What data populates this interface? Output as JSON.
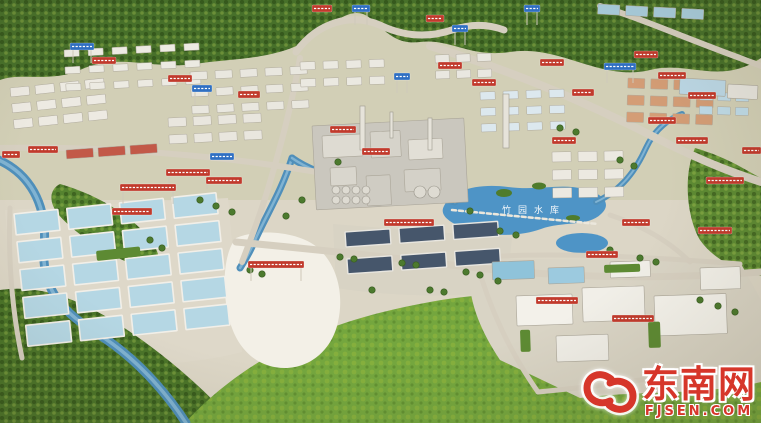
{
  "image_alt": "Aerial photograph of a physical scale model (sand table) of an industrial park: forested hills on top, chemical plant with chimneys in the center, blue reservoir, grids of blue ponds on the left, dark-roofed warehouses, a white undeveloped plot, a factory campus at bottom right, many small red banner labels and blue road signs, green fields in the foreground",
  "watermark": {
    "site_name": "东南网",
    "site_url": "FJSEN.COM",
    "color": "#d6362a"
  },
  "pond_label": {
    "text": "竹园水库",
    "x": 502,
    "y": 213
  },
  "colors": {
    "sign_red": "#c13a2c",
    "sign_blue": "#2f6fc2",
    "forest_dark": "#47702a",
    "grass_bright": "#74a63e",
    "water": "#4f8fba",
    "pond": "#4e94c6",
    "ground": "#d9d3c3"
  },
  "scene": {
    "terrain": [
      {
        "n": "base-upper",
        "d": "M0,0 H761 V210 H0 Z",
        "fill": "#d2cfb6"
      },
      {
        "n": "base-lower",
        "d": "M0,200 H761 V423 H0 Z",
        "fill": "#dcd6c6"
      },
      {
        "n": "pond-grid-platform",
        "d": "M5,210 L228,198 L242,352 C180,368 88,370 18,358 Z",
        "fill": "#ded8c9"
      },
      {
        "n": "warehouse-platform",
        "d": "M333,224 L512,238 L506,292 C450,298 388,296 336,288 Z",
        "fill": "#d8d3c4"
      },
      {
        "n": "top-forest",
        "d": "M0,0 H761 V58 C720,86 688,60 650,70 C600,82 560,44 510,52 C470,58 450,38 420,42 C395,45 385,30 370,18 C350,2 330,28 305,42 C270,60 235,58 195,64 C150,70 120,52 80,70 C50,83 20,72 0,80 Z",
        "fill": "#47702a",
        "tex": 1
      },
      {
        "n": "right-hillside",
        "d": "M695,148 C730,158 750,173 761,178 L761,276 C740,272 714,260 700,240 C688,220 682,178 695,148 Z",
        "fill": "#5d8a33",
        "tex": 1
      },
      {
        "n": "riverside-trees",
        "d": "M60,184 C95,194 130,214 150,239 C165,259 160,274 140,267 C110,257 75,234 58,214 C48,201 50,189 60,184 Z",
        "fill": "#55832f",
        "tex": 1
      },
      {
        "n": "bottom-left-forest",
        "d": "M0,290 C40,284 80,300 115,322 C160,350 200,385 235,423 L0,423 Z",
        "fill": "#4a7429",
        "tex": 1
      },
      {
        "n": "bottom-grass",
        "d": "M185,423 C248,354 330,320 430,302 C540,282 650,300 761,345 L761,423 Z",
        "fill": "#74a63e",
        "tex": 2
      },
      {
        "n": "campus-platform",
        "d": "M470,258 L740,262 L761,300 L761,382 C700,396 640,390 580,398 L500,360 C480,330 465,296 470,258 Z",
        "fill": "#d9d4c5"
      },
      {
        "n": "undeveloped-white-area",
        "d": "M236,238 C260,228 300,232 318,248 C338,266 344,295 338,322 C332,350 310,368 285,368 C258,368 238,350 230,322 C222,295 222,255 236,238 Z",
        "fill": "#f3f0e7"
      },
      {
        "n": "reservoir",
        "d": "M444,206 C452,190 478,183 508,187 C538,191 560,183 584,189 C604,194 612,204 601,214 C588,227 562,221 541,229 C516,238 482,236 463,228 C449,222 439,215 444,206 Z",
        "fill": "#4e94c6"
      },
      {
        "n": "small-pond",
        "d": "M556,243 a26,10 0 1 0 52,0 a26,10 0 1 0 -52,0",
        "fill": "#4e94c6"
      },
      {
        "n": "island",
        "d": "M496,193 a8,4 0 1 0 16,0 a8,4 0 1 0 -16,0",
        "fill": "#4f7c2c"
      },
      {
        "n": "island",
        "d": "M532,186 a7,3.5 0 1 0 14,0 a7,3.5 0 1 0 -14,0",
        "fill": "#4f7c2c"
      },
      {
        "n": "island",
        "d": "M566,218 a7,3 0 1 0 14,0 a7,3 0 1 0 -14,0",
        "fill": "#4f7c2c"
      }
    ],
    "rivers": [
      {
        "d": "M-6,158 C30,172 48,205 44,248 C41,292 66,314 98,334 C135,357 166,392 186,423",
        "w": 9,
        "c": "#4f8fba",
        "hw": 3.5,
        "hc": "#8cbcd8"
      },
      {
        "d": "M292,158 C282,190 268,212 256,238 C250,252 244,262 240,268",
        "w": 7,
        "c": "#4f8fba",
        "hw": 2.5,
        "hc": "#8cbcd8"
      },
      {
        "d": "M455,202 C420,192 382,186 348,180 C326,176 306,168 292,158",
        "w": 7,
        "c": "#4f8fba",
        "hw": 2.5,
        "hc": "#8cbcd8"
      },
      {
        "d": "M596,202 C622,190 636,170 646,148 C654,131 666,120 682,114",
        "w": 6,
        "c": "#4f8fba",
        "hw": 2,
        "hc": "#8cbcd8"
      }
    ],
    "roads": [
      {
        "d": "M296,52 C318,22 352,12 382,26 C404,36 428,38 452,30 C470,24 488,24 504,30",
        "w": 7
      },
      {
        "d": "M430,46 C510,70 590,104 660,140 C710,165 740,175 761,182",
        "w": 8
      },
      {
        "d": "M300,58 C292,104 282,142 270,182 C262,210 252,236 242,262",
        "w": 6
      },
      {
        "d": "M0,148 C80,146 170,152 250,162 C310,170 340,176 370,182",
        "w": 6
      },
      {
        "d": "M236,242 C300,248 380,256 460,266 C560,278 660,280 761,272",
        "w": 7
      },
      {
        "d": "M600,6 C640,18 690,40 740,58 C750,62 756,64 761,66",
        "w": 6
      },
      {
        "d": "M610,215 C640,225 668,240 690,262",
        "w": 5
      },
      {
        "d": "M10,208 C8,260 12,310 22,358",
        "w": 5
      },
      {
        "d": "M470,258 C540,252 640,256 740,264",
        "w": 5
      },
      {
        "d": "M476,260 C490,310 510,352 538,392",
        "w": 5
      },
      {
        "d": "M538,392 C600,386 660,378 722,368",
        "w": 5
      },
      {
        "d": "M452,210 L598,224",
        "w": 2.5,
        "c": "#ebe7dc",
        "dash": "4 3"
      }
    ],
    "clusters": [
      {
        "x": 10,
        "y": 88,
        "cols": 4,
        "rows": 3,
        "w": 19,
        "h": 9,
        "gx": 6,
        "gy": 7,
        "rot": -6,
        "roof": "#edeae2"
      },
      {
        "x": 66,
        "y": 150,
        "cols": 3,
        "rows": 1,
        "w": 27,
        "h": 9,
        "gx": 5,
        "gy": 0,
        "rot": -4,
        "roof": "#c25948"
      },
      {
        "x": 64,
        "y": 50,
        "cols": 6,
        "rows": 3,
        "w": 15,
        "h": 7,
        "gx": 9,
        "gy": 10,
        "rot": -3,
        "roof": "#eceae2"
      },
      {
        "x": 190,
        "y": 72,
        "cols": 5,
        "rows": 3,
        "w": 17,
        "h": 8,
        "gx": 8,
        "gy": 9,
        "rot": -3,
        "roof": "#e9e7df"
      },
      {
        "x": 300,
        "y": 62,
        "cols": 4,
        "rows": 2,
        "w": 15,
        "h": 8,
        "gx": 8,
        "gy": 9,
        "rot": -2,
        "roof": "#ebe9e1"
      },
      {
        "x": 168,
        "y": 118,
        "cols": 4,
        "rows": 2,
        "w": 18,
        "h": 9,
        "gx": 7,
        "gy": 8,
        "rot": -3,
        "roof": "#e9e6de"
      },
      {
        "x": 480,
        "y": 92,
        "cols": 4,
        "rows": 3,
        "w": 15,
        "h": 8,
        "gx": 8,
        "gy": 8,
        "rot": -2,
        "roof": "#dce8ee"
      },
      {
        "x": 628,
        "y": 78,
        "cols": 4,
        "rows": 3,
        "w": 17,
        "h": 10,
        "gx": 6,
        "gy": 7,
        "rot": 2,
        "roof": "#d49d76"
      },
      {
        "x": 700,
        "y": 92,
        "cols": 3,
        "rows": 2,
        "w": 13,
        "h": 8,
        "gx": 5,
        "gy": 6,
        "rot": 2,
        "roof": "#bfdbe8"
      },
      {
        "x": 552,
        "y": 152,
        "cols": 3,
        "rows": 3,
        "w": 19,
        "h": 10,
        "gx": 7,
        "gy": 8,
        "rot": -1,
        "roof": "#ece9e1"
      },
      {
        "x": 345,
        "y": 232,
        "cols": 3,
        "rows": 2,
        "w": 45,
        "h": 15,
        "gx": 9,
        "gy": 12,
        "rot": -4,
        "roof": "#46566b",
        "stroke": "#e8e6e0",
        "sw": 1.4
      },
      {
        "x": 14,
        "y": 214,
        "cols": 4,
        "rows": 5,
        "w": 44,
        "h": 21,
        "gx": 9,
        "gy": 7,
        "rot": -6,
        "roof": "#b5d7e4",
        "stroke": "#f2efe8",
        "sw": 1.6
      },
      {
        "x": 598,
        "y": 4,
        "cols": 4,
        "rows": 1,
        "w": 22,
        "h": 10,
        "gx": 6,
        "gy": 0,
        "rot": 3,
        "roof": "#a9cede"
      },
      {
        "x": 435,
        "y": 55,
        "cols": 3,
        "rows": 2,
        "w": 14,
        "h": 8,
        "gx": 7,
        "gy": 8,
        "rot": -2,
        "roof": "#e9e7e0"
      }
    ],
    "buildings": [
      [
        312,
        126,
        152,
        84,
        -3,
        "#cac7be"
      ],
      [
        322,
        136,
        40,
        22,
        -3,
        "#dedbd2"
      ],
      [
        370,
        132,
        30,
        26,
        -3,
        "#d6d3ca"
      ],
      [
        408,
        140,
        34,
        20,
        -3,
        "#e2dfd6"
      ],
      [
        330,
        168,
        26,
        18,
        -3,
        "#d9d6cd"
      ],
      [
        404,
        170,
        36,
        22,
        -3,
        "#d4d1c8"
      ],
      [
        366,
        176,
        24,
        30,
        -3,
        "#cfccc3"
      ],
      [
        516,
        296,
        56,
        30,
        -2,
        "#f3f1ea"
      ],
      [
        582,
        288,
        62,
        34,
        -2,
        "#f1efe8"
      ],
      [
        654,
        296,
        72,
        40,
        -2,
        "#f4f2eb"
      ],
      [
        556,
        336,
        52,
        26,
        -2,
        "#efede6"
      ],
      [
        492,
        262,
        42,
        18,
        -2,
        "#8fc3da"
      ],
      [
        548,
        268,
        36,
        16,
        -2,
        "#9ccadf"
      ],
      [
        610,
        262,
        40,
        16,
        -2,
        "#f0eee7"
      ],
      [
        700,
        268,
        40,
        22,
        -2,
        "#f2f0e9"
      ],
      [
        680,
        78,
        46,
        16,
        3,
        "#bcd8e6"
      ],
      [
        728,
        84,
        30,
        14,
        3,
        "#e7e5de"
      ]
    ],
    "stacks": [
      [
        360,
        106,
        5,
        44
      ],
      [
        503,
        94,
        6,
        54
      ],
      [
        428,
        118,
        4,
        32
      ],
      [
        390,
        112,
        3,
        26
      ]
    ],
    "tanks": [
      [
        336,
        190,
        4
      ],
      [
        346,
        190,
        4
      ],
      [
        356,
        190,
        4
      ],
      [
        366,
        190,
        4
      ],
      [
        336,
        200,
        4
      ],
      [
        346,
        200,
        4
      ],
      [
        356,
        200,
        4
      ],
      [
        366,
        200,
        4
      ],
      [
        420,
        192,
        6
      ],
      [
        434,
        192,
        6
      ]
    ],
    "hedges": [
      [
        96,
        251,
        44,
        10,
        -6
      ],
      [
        604,
        265,
        36,
        8,
        -2
      ],
      [
        648,
        322,
        12,
        26,
        -2
      ],
      [
        520,
        330,
        10,
        22,
        -2
      ]
    ],
    "trees": [
      [
        250,
        270
      ],
      [
        262,
        274
      ],
      [
        340,
        257
      ],
      [
        354,
        259
      ],
      [
        402,
        263
      ],
      [
        416,
        265
      ],
      [
        466,
        272
      ],
      [
        480,
        275
      ],
      [
        498,
        281
      ],
      [
        338,
        162
      ],
      [
        302,
        200
      ],
      [
        286,
        216
      ],
      [
        610,
        250
      ],
      [
        640,
        258
      ],
      [
        656,
        262
      ],
      [
        700,
        300
      ],
      [
        718,
        306
      ],
      [
        735,
        312
      ],
      [
        560,
        128
      ],
      [
        576,
        132
      ],
      [
        620,
        160
      ],
      [
        634,
        166
      ],
      [
        200,
        200
      ],
      [
        216,
        206
      ],
      [
        232,
        212
      ],
      [
        150,
        240
      ],
      [
        162,
        248
      ],
      [
        500,
        231
      ],
      [
        516,
        235
      ],
      [
        470,
        211
      ],
      [
        430,
        290
      ],
      [
        444,
        292
      ],
      [
        372,
        290
      ]
    ],
    "signs": [
      [
        28,
        146,
        30,
        "r",
        0
      ],
      [
        2,
        151,
        18,
        "r",
        0
      ],
      [
        112,
        208,
        40,
        "r",
        0
      ],
      [
        248,
        261,
        56,
        "r",
        1
      ],
      [
        384,
        219,
        50,
        "r",
        0
      ],
      [
        330,
        126,
        26,
        "r",
        0
      ],
      [
        362,
        148,
        28,
        "r",
        0
      ],
      [
        166,
        169,
        44,
        "r",
        1
      ],
      [
        120,
        184,
        56,
        "r",
        1
      ],
      [
        206,
        177,
        36,
        "r",
        0
      ],
      [
        92,
        57,
        24,
        "r",
        0
      ],
      [
        168,
        75,
        24,
        "r",
        0
      ],
      [
        238,
        91,
        22,
        "r",
        0
      ],
      [
        312,
        5,
        20,
        "r",
        0
      ],
      [
        426,
        15,
        18,
        "r",
        0
      ],
      [
        438,
        62,
        24,
        "r",
        0
      ],
      [
        472,
        79,
        24,
        "r",
        0
      ],
      [
        540,
        59,
        24,
        "r",
        0
      ],
      [
        572,
        89,
        22,
        "r",
        0
      ],
      [
        552,
        137,
        24,
        "r",
        0
      ],
      [
        634,
        51,
        24,
        "r",
        0
      ],
      [
        658,
        72,
        28,
        "r",
        0
      ],
      [
        688,
        92,
        28,
        "r",
        0
      ],
      [
        648,
        117,
        28,
        "r",
        0
      ],
      [
        676,
        137,
        32,
        "r",
        0
      ],
      [
        706,
        177,
        38,
        "r",
        0
      ],
      [
        698,
        227,
        34,
        "r",
        0
      ],
      [
        742,
        147,
        19,
        "r",
        0
      ],
      [
        586,
        251,
        32,
        "r",
        0
      ],
      [
        622,
        219,
        28,
        "r",
        0
      ],
      [
        536,
        297,
        42,
        "r",
        0
      ],
      [
        612,
        315,
        42,
        "r",
        0
      ],
      [
        70,
        43,
        24,
        "b",
        1
      ],
      [
        192,
        85,
        20,
        "b",
        1
      ],
      [
        352,
        5,
        18,
        "b",
        1
      ],
      [
        394,
        73,
        16,
        "b",
        1
      ],
      [
        452,
        25,
        16,
        "b",
        1
      ],
      [
        604,
        63,
        32,
        "b",
        1
      ],
      [
        210,
        153,
        24,
        "b",
        0
      ],
      [
        524,
        5,
        16,
        "b",
        1
      ]
    ]
  }
}
